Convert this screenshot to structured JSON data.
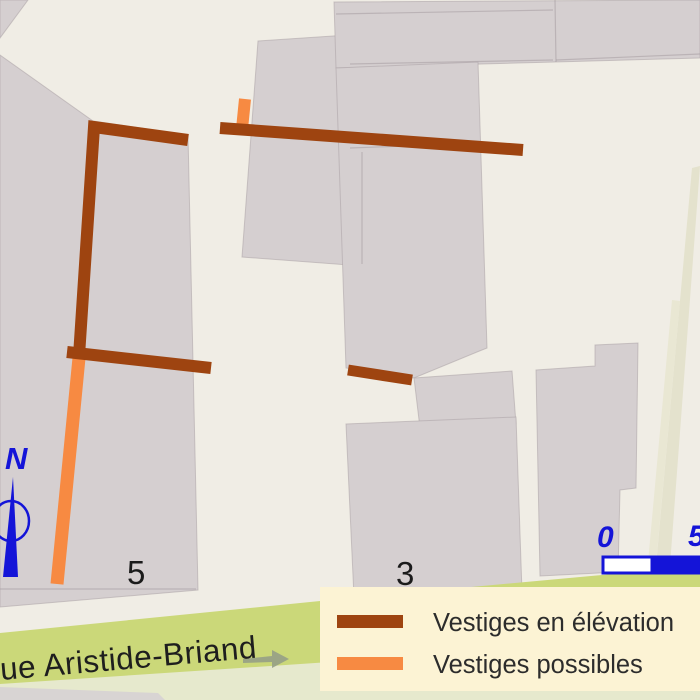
{
  "map": {
    "street_label": "rue Aristide-Briand",
    "north_label": "N",
    "parcels": [
      {
        "number": "5"
      },
      {
        "number": "3"
      }
    ],
    "scale": {
      "start": "0",
      "end": "5"
    }
  },
  "legend": {
    "items": [
      {
        "label": "Vestiges en élévation",
        "color": "#9e4410"
      },
      {
        "label": "Vestiges possibles",
        "color": "#f78a42"
      }
    ]
  },
  "colors": {
    "vestige_elevation": "#9e4410",
    "vestige_possible": "#f78a42",
    "north_scale_blue": "#1414d8",
    "street_band_green": "#cbd879",
    "legend_background": "#fcf3d4",
    "parcel_gray": "#d5cfd0",
    "background_cream": "#f0ede5"
  }
}
